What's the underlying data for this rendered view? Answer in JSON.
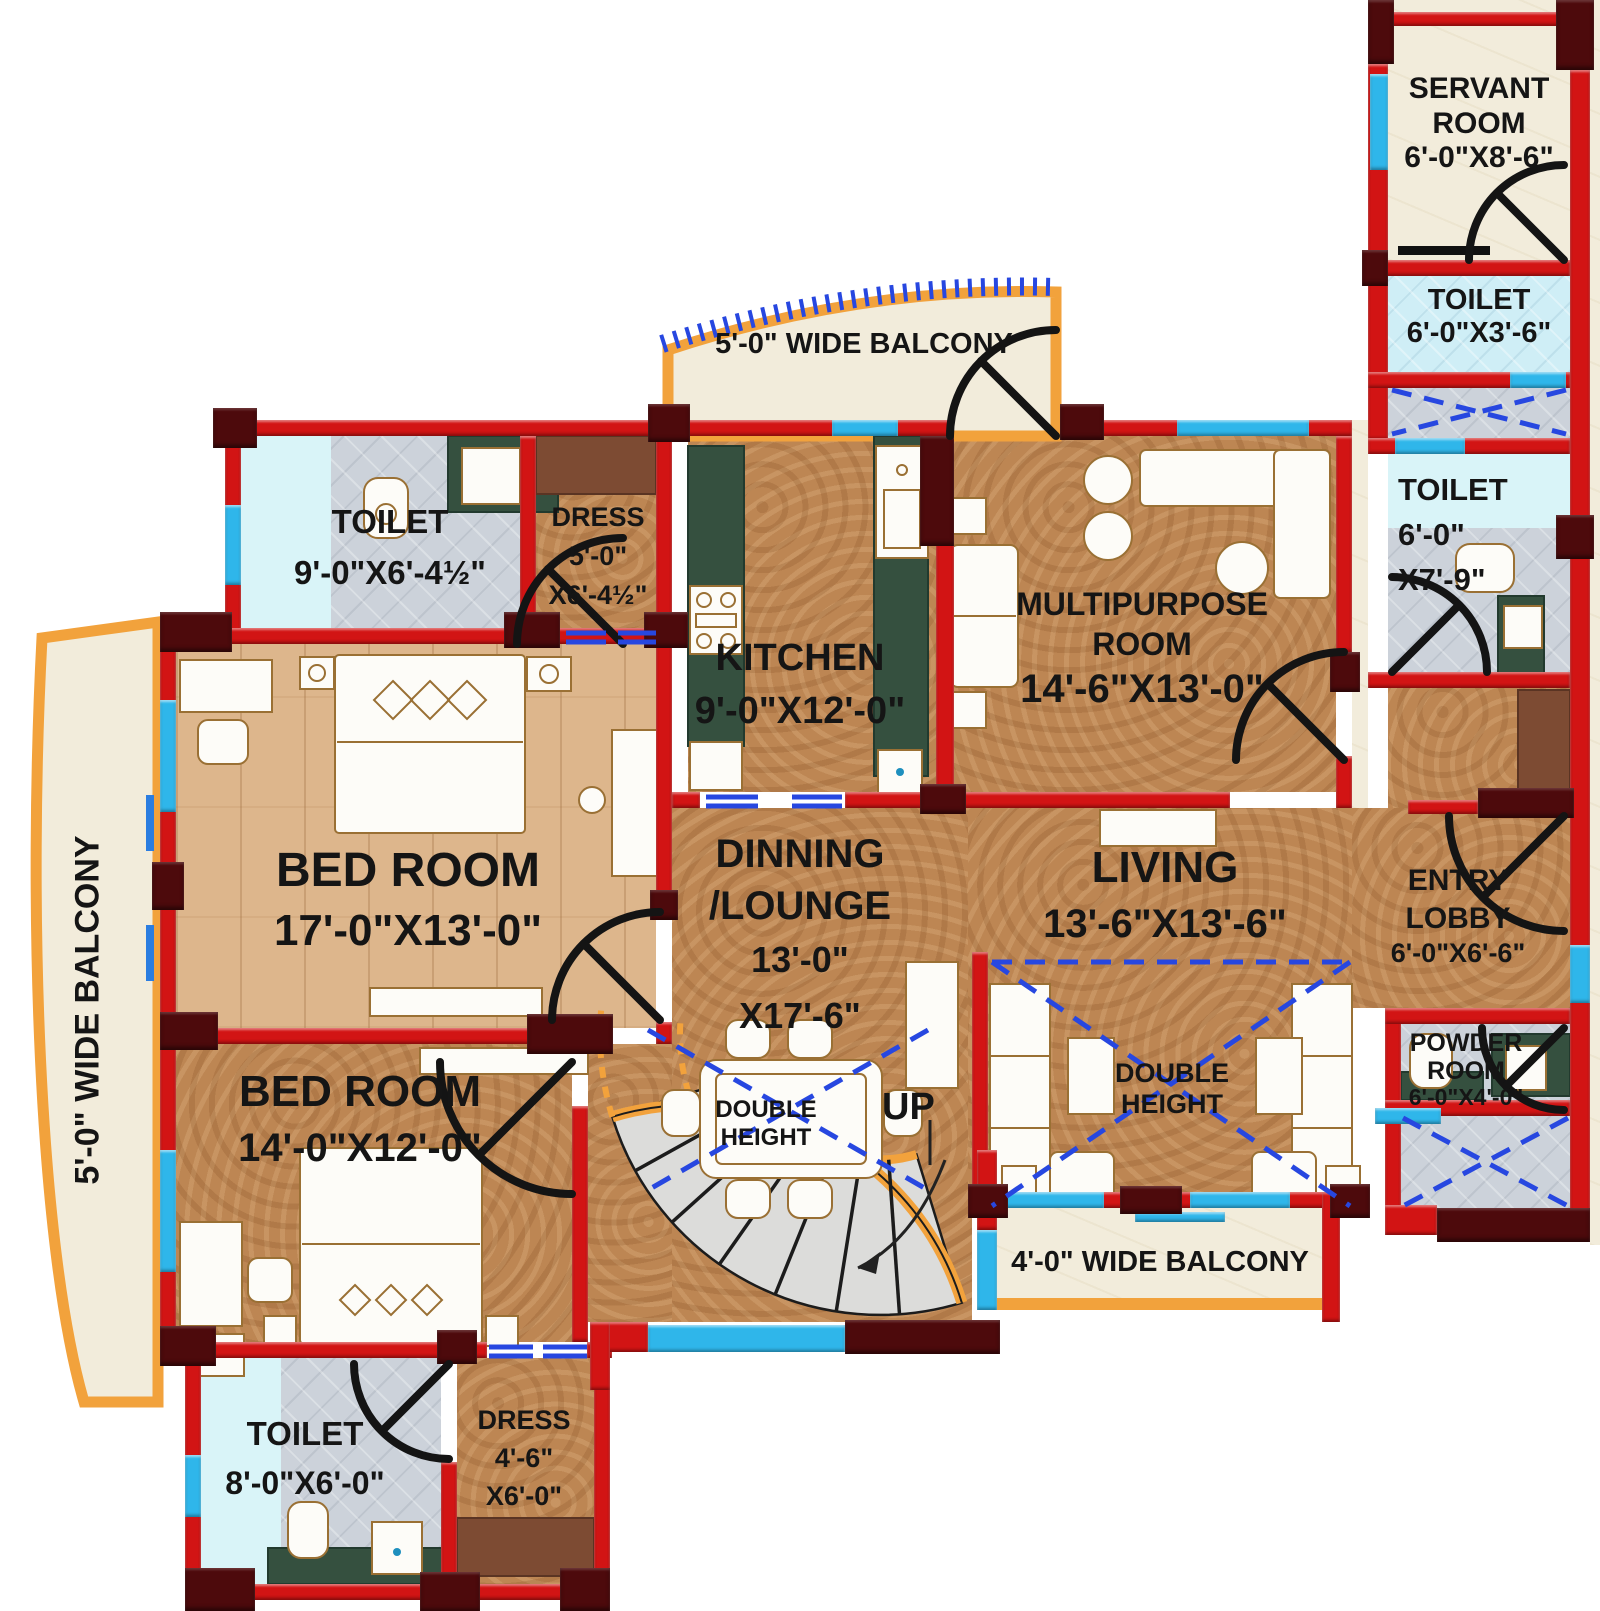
{
  "title": "Apartment Floor Plan",
  "colors": {
    "wall_red": "#d21414",
    "wall_maroon": "#4d0a0c",
    "window_cyan": "#2fb6ea",
    "balcony_orange": "#f2a23c",
    "floor_cork": "#bd8653",
    "floor_wood": "#ddb68c",
    "floor_marble": "#f2ecdb",
    "tile_gray": "#ccd2da",
    "tile_blue": "#cfeef6",
    "tile_lightcyan": "#d9f4f8",
    "counter_green": "#35503f",
    "dash_blue": "#2747e0",
    "wardrobe_brown": "#7d4b33",
    "text_black": "#151515"
  },
  "rooms": {
    "servant": {
      "l1": "SERVANT",
      "l2": "ROOM",
      "dims": "6'-0\"X8'-6\""
    },
    "toilet_tr": {
      "l1": "TOILET",
      "dims": "6'-0\"X3'-6\""
    },
    "toilet_r": {
      "l1": "TOILET",
      "d1": "6'-0\"",
      "d2": "X7'-9\""
    },
    "toilet_master": {
      "l1": "TOILET",
      "dims": "9'-0\"X6'-4½\""
    },
    "dress_master": {
      "l1": "DRESS",
      "d1": "5'-0\"",
      "d2": "X6'-4½\""
    },
    "kitchen": {
      "l1": "KITCHEN",
      "dims": "9'-0\"X12'-0\""
    },
    "multipurpose": {
      "l1": "MULTIPURPOSE",
      "l2": "ROOM",
      "dims": "14'-6\"X13'-0\""
    },
    "bedroom1": {
      "l1": "BED ROOM",
      "dims": "17'-0\"X13'-0\""
    },
    "dinning": {
      "l1": "DINNING",
      "l2": "/LOUNGE",
      "d1": "13'-0\"",
      "d2": "X17'-6\""
    },
    "living": {
      "l1": "LIVING",
      "dims": "13'-6\"X13'-6\""
    },
    "entry_lobby": {
      "l1": "ENTRY",
      "l2": "LOBBY",
      "dims": "6'-0\"X6'-6\""
    },
    "powder": {
      "l1": "POWDER",
      "l2": "ROOM",
      "dims": "6'-0\"X4'-0\""
    },
    "bedroom2": {
      "l1": "BED ROOM",
      "dims": "14'-0\"X12'-0\""
    },
    "toilet2": {
      "l1": "TOILET",
      "dims": "8'-0\"X6'-0\""
    },
    "dress2": {
      "l1": "DRESS",
      "d1": "4'-6\"",
      "d2": "X6'-0\""
    }
  },
  "balconies": {
    "top": "5'-0\" WIDE BALCONY",
    "left": "5'-0\" WIDE BALCONY",
    "bottom": "4'-0\" WIDE BALCONY"
  },
  "annotations": {
    "up": "UP",
    "dh1": "DOUBLE",
    "dh2": "HEIGHT"
  }
}
